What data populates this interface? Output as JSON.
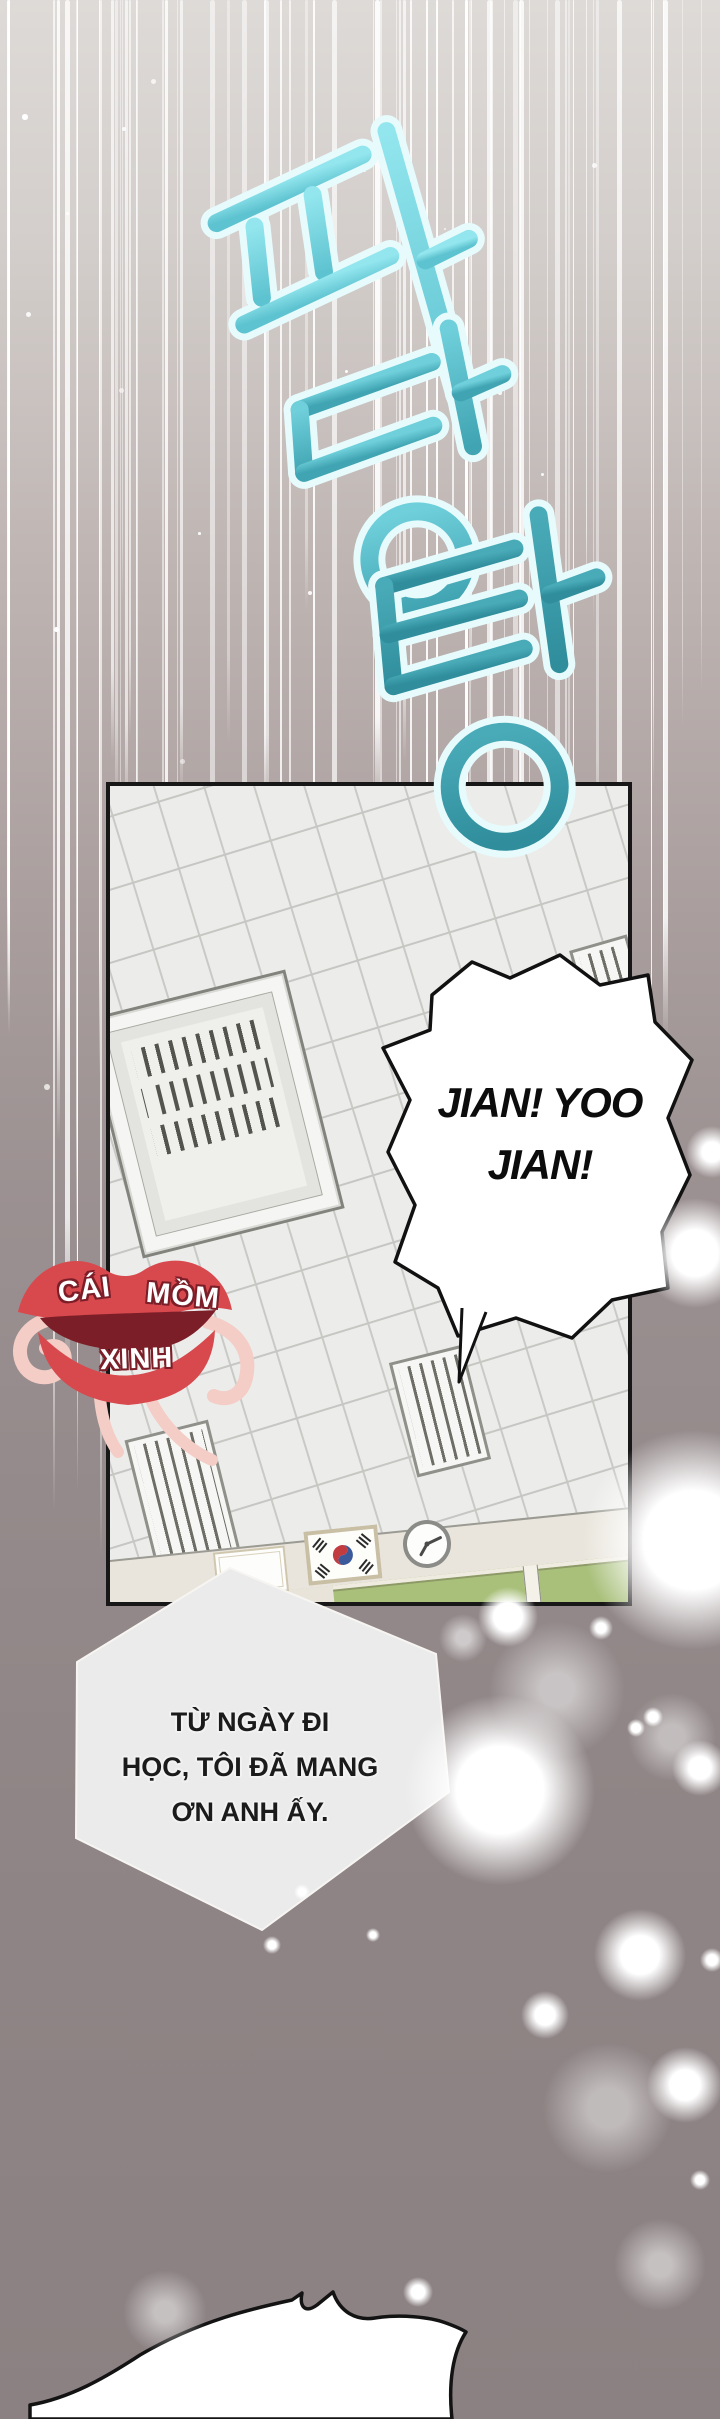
{
  "sfx": {
    "text": "파당탕",
    "chars": [
      "파",
      "당",
      "탕"
    ],
    "color_light": "#8fe3eb",
    "color_dark": "#2f8d9c"
  },
  "speech_bubble": {
    "line1": "JIAN! YOO",
    "line2": "JIAN!"
  },
  "caption": {
    "line1": "TỪ NGÀY ĐI",
    "line2": "HỌC, TÔI ĐÃ MANG",
    "line3": "ƠN ANH ẤY."
  },
  "translator_logo": {
    "word1": "CÁI",
    "word2": "MỒM",
    "word3": "XINH",
    "lips_color": "#d8494e"
  },
  "panel_scene": {
    "items": [
      "wall-tiles",
      "air-vent-large",
      "window-grille-top-right",
      "window-grille-middle",
      "window-grille-left",
      "wall-sign",
      "korean-flag-plaque",
      "wall-clock",
      "chalkboard"
    ]
  },
  "colors": {
    "page_top": "#dedad7",
    "page_bottom": "#8b8182",
    "panel_border": "#171717",
    "board_green": "#a9c07b"
  }
}
